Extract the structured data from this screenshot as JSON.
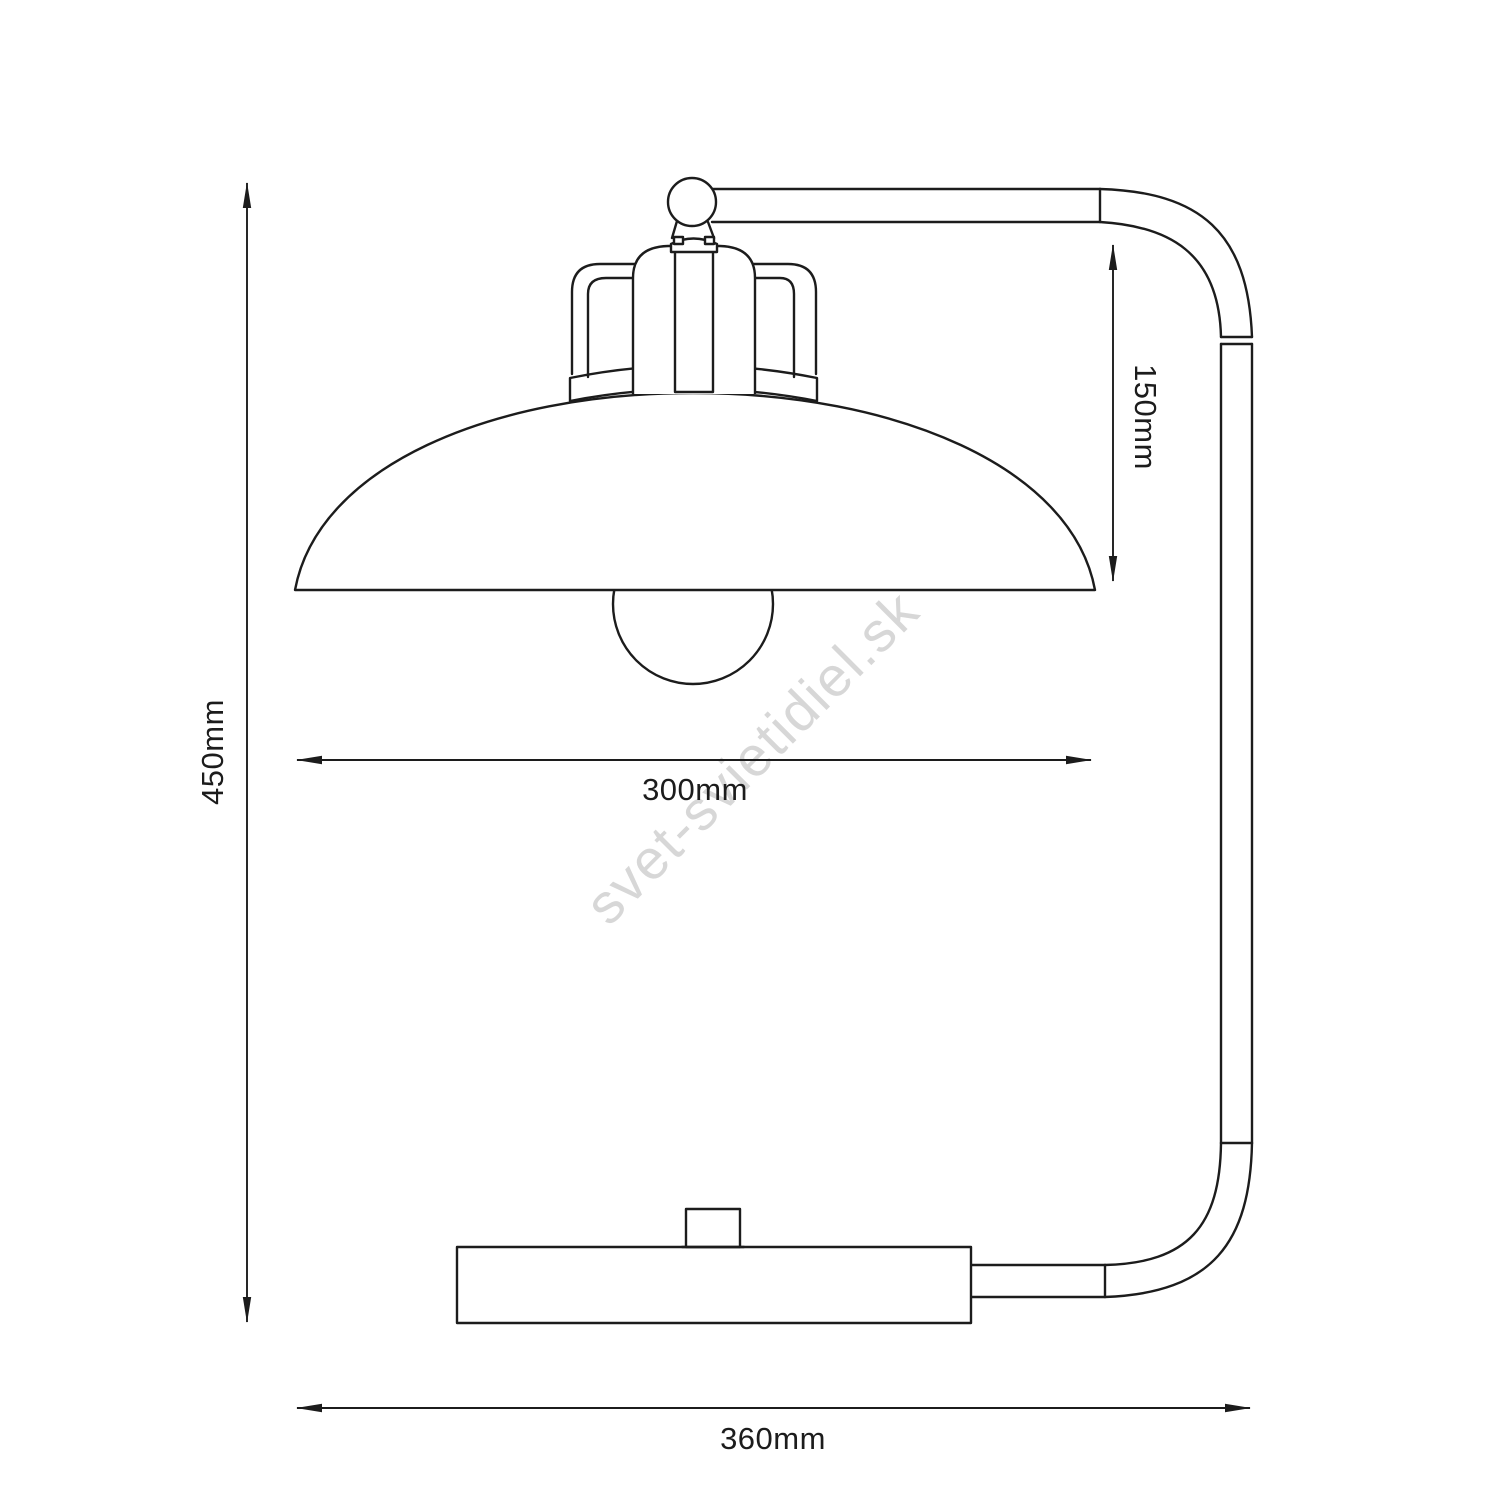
{
  "diagram": {
    "type": "technical-dimension-drawing",
    "subject": "table lamp with dome shade, curved stand tube and base",
    "watermark": "svet-svietidiel.sk",
    "colors": {
      "line": "#1c1c1c",
      "background": "#ffffff",
      "watermark": "#d7d7d7"
    },
    "dimensions": {
      "total_height": {
        "label": "450mm",
        "value": 450,
        "unit": "mm",
        "orientation": "vertical-left"
      },
      "base_width": {
        "label": "360mm",
        "value": 360,
        "unit": "mm",
        "orientation": "horizontal-bottom"
      },
      "shade_diameter": {
        "label": "300mm",
        "value": 300,
        "unit": "mm",
        "orientation": "horizontal-middle"
      },
      "shade_drop": {
        "label": "150mm",
        "value": 150,
        "unit": "mm",
        "orientation": "vertical-right"
      }
    }
  }
}
